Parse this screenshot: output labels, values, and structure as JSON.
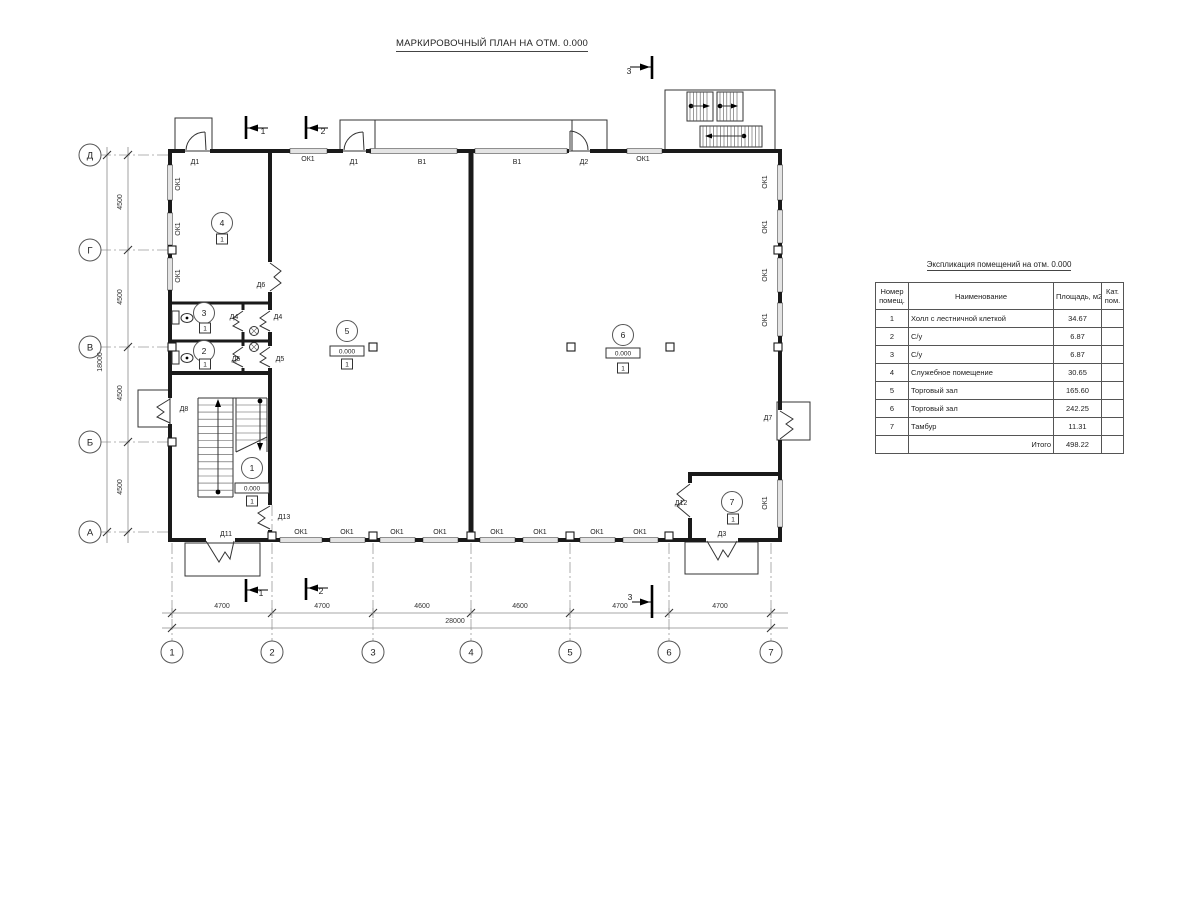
{
  "title": "МАРКИРОВОЧНЫЙ ПЛАН НА ОТМ. 0.000",
  "table": {
    "title": "Экспликация помещений на отм. 0.000",
    "headers": {
      "num1": "Номер",
      "num2": "помещ.",
      "name": "Наименование",
      "area": "Площадь,  м2",
      "cat1": "Кат.",
      "cat2": "пом."
    },
    "rows": [
      {
        "num": "1",
        "name": "Холл с лестничной клеткой",
        "area": "34.67",
        "cat": ""
      },
      {
        "num": "2",
        "name": "С/у",
        "area": "6.87",
        "cat": ""
      },
      {
        "num": "3",
        "name": "С/у",
        "area": "6.87",
        "cat": ""
      },
      {
        "num": "4",
        "name": "Служебное помещение",
        "area": "30.65",
        "cat": ""
      },
      {
        "num": "5",
        "name": "Торговый зал",
        "area": "165.60",
        "cat": ""
      },
      {
        "num": "6",
        "name": "Торговый зал",
        "area": "242.25",
        "cat": ""
      },
      {
        "num": "7",
        "name": "Тамбур",
        "area": "11.31",
        "cat": ""
      }
    ],
    "total_label": "Итого",
    "total_value": "498.22"
  },
  "plan": {
    "labels": [
      {
        "t": "Д1",
        "x": 195,
        "y": 164
      },
      {
        "t": "ОК1",
        "x": 308,
        "y": 161
      },
      {
        "t": "Д1",
        "x": 354,
        "y": 164
      },
      {
        "t": "В1",
        "x": 422,
        "y": 164
      },
      {
        "t": "В1",
        "x": 517,
        "y": 164
      },
      {
        "t": "Д2",
        "x": 584,
        "y": 164
      },
      {
        "t": "ОК1",
        "x": 643,
        "y": 161
      },
      {
        "t": "ОК1",
        "x": 180,
        "y": 184,
        "r": -90
      },
      {
        "t": "ОК1",
        "x": 180,
        "y": 229,
        "r": -90
      },
      {
        "t": "ОК1",
        "x": 180,
        "y": 276,
        "r": -90
      },
      {
        "t": "ОК1",
        "x": 767,
        "y": 182,
        "r": -90
      },
      {
        "t": "ОК1",
        "x": 767,
        "y": 227,
        "r": -90
      },
      {
        "t": "ОК1",
        "x": 767,
        "y": 275,
        "r": -90
      },
      {
        "t": "ОК1",
        "x": 767,
        "y": 320,
        "r": -90
      },
      {
        "t": "ОК1",
        "x": 767,
        "y": 503,
        "r": -90
      },
      {
        "t": "Д8",
        "x": 184,
        "y": 411
      },
      {
        "t": "Д7",
        "x": 768,
        "y": 420
      },
      {
        "t": "Д6",
        "x": 261,
        "y": 287
      },
      {
        "t": "Д4",
        "x": 234,
        "y": 319
      },
      {
        "t": "Д4",
        "x": 278,
        "y": 319
      },
      {
        "t": "Д5",
        "x": 236,
        "y": 361
      },
      {
        "t": "Д5",
        "x": 280,
        "y": 361
      },
      {
        "t": "Д13",
        "x": 284,
        "y": 519
      },
      {
        "t": "Д11",
        "x": 226,
        "y": 536
      },
      {
        "t": "Д12",
        "x": 681,
        "y": 505
      },
      {
        "t": "Д3",
        "x": 722,
        "y": 536
      },
      {
        "t": "ОК1",
        "x": 301,
        "y": 534
      },
      {
        "t": "ОК1",
        "x": 347,
        "y": 534
      },
      {
        "t": "ОК1",
        "x": 397,
        "y": 534
      },
      {
        "t": "ОК1",
        "x": 440,
        "y": 534
      },
      {
        "t": "ОК1",
        "x": 497,
        "y": 534
      },
      {
        "t": "ОК1",
        "x": 540,
        "y": 534
      },
      {
        "t": "ОК1",
        "x": 597,
        "y": 534
      },
      {
        "t": "ОК1",
        "x": 640,
        "y": 534
      }
    ],
    "rooms": [
      {
        "n": "1",
        "x": 252,
        "y": 468
      },
      {
        "n": "2",
        "x": 204,
        "y": 351
      },
      {
        "n": "3",
        "x": 204,
        "y": 313
      },
      {
        "n": "4",
        "x": 222,
        "y": 223
      },
      {
        "n": "5",
        "x": 347,
        "y": 331
      },
      {
        "n": "6",
        "x": 623,
        "y": 335
      },
      {
        "n": "7",
        "x": 732,
        "y": 502
      }
    ],
    "elevations": [
      {
        "t": "0.000",
        "x": 252,
        "y": 488
      },
      {
        "t": "0.000",
        "x": 347,
        "y": 351
      },
      {
        "t": "0.000",
        "x": 623,
        "y": 353
      }
    ],
    "floor_markers": [
      {
        "t": "1",
        "x": 252,
        "y": 501
      },
      {
        "t": "1",
        "x": 205,
        "y": 364
      },
      {
        "t": "1",
        "x": 205,
        "y": 328
      },
      {
        "t": "1",
        "x": 222,
        "y": 239
      },
      {
        "t": "1",
        "x": 347,
        "y": 364
      },
      {
        "t": "1",
        "x": 623,
        "y": 368
      },
      {
        "t": "1",
        "x": 733,
        "y": 519
      }
    ],
    "grid_cols": {
      "y": 652,
      "items": [
        {
          "n": "1",
          "x": 172
        },
        {
          "n": "2",
          "x": 272
        },
        {
          "n": "3",
          "x": 373
        },
        {
          "n": "4",
          "x": 471
        },
        {
          "n": "5",
          "x": 570
        },
        {
          "n": "6",
          "x": 669
        },
        {
          "n": "7",
          "x": 771
        }
      ]
    },
    "grid_rows": {
      "x": 90,
      "items": [
        {
          "n": "Д",
          "y": 155
        },
        {
          "n": "Г",
          "y": 250
        },
        {
          "n": "В",
          "y": 347
        },
        {
          "n": "Б",
          "y": 442
        },
        {
          "n": "А",
          "y": 532
        }
      ]
    },
    "dims_bottom": {
      "y": 608,
      "items": [
        {
          "t": "4700",
          "x": 222
        },
        {
          "t": "4700",
          "x": 322
        },
        {
          "t": "4600",
          "x": 422
        },
        {
          "t": "4600",
          "x": 520
        },
        {
          "t": "4700",
          "x": 620
        },
        {
          "t": "4700",
          "x": 720
        }
      ],
      "total": {
        "t": "28000",
        "x": 455,
        "y": 623
      }
    },
    "dims_left": {
      "x": 122,
      "items": [
        {
          "t": "4500",
          "y": 202
        },
        {
          "t": "4500",
          "y": 297
        },
        {
          "t": "4500",
          "y": 393
        },
        {
          "t": "4500",
          "y": 487
        }
      ],
      "total": {
        "t": "18000",
        "x": 102,
        "y": 362
      }
    },
    "sections": [
      {
        "t": "1",
        "x": 263,
        "y": 134
      },
      {
        "t": "2",
        "x": 323,
        "y": 134
      },
      {
        "t": "3",
        "x": 629,
        "y": 74
      },
      {
        "t": "1",
        "x": 261,
        "y": 596
      },
      {
        "t": "2",
        "x": 321,
        "y": 594
      },
      {
        "t": "3",
        "x": 630,
        "y": 600
      }
    ]
  }
}
